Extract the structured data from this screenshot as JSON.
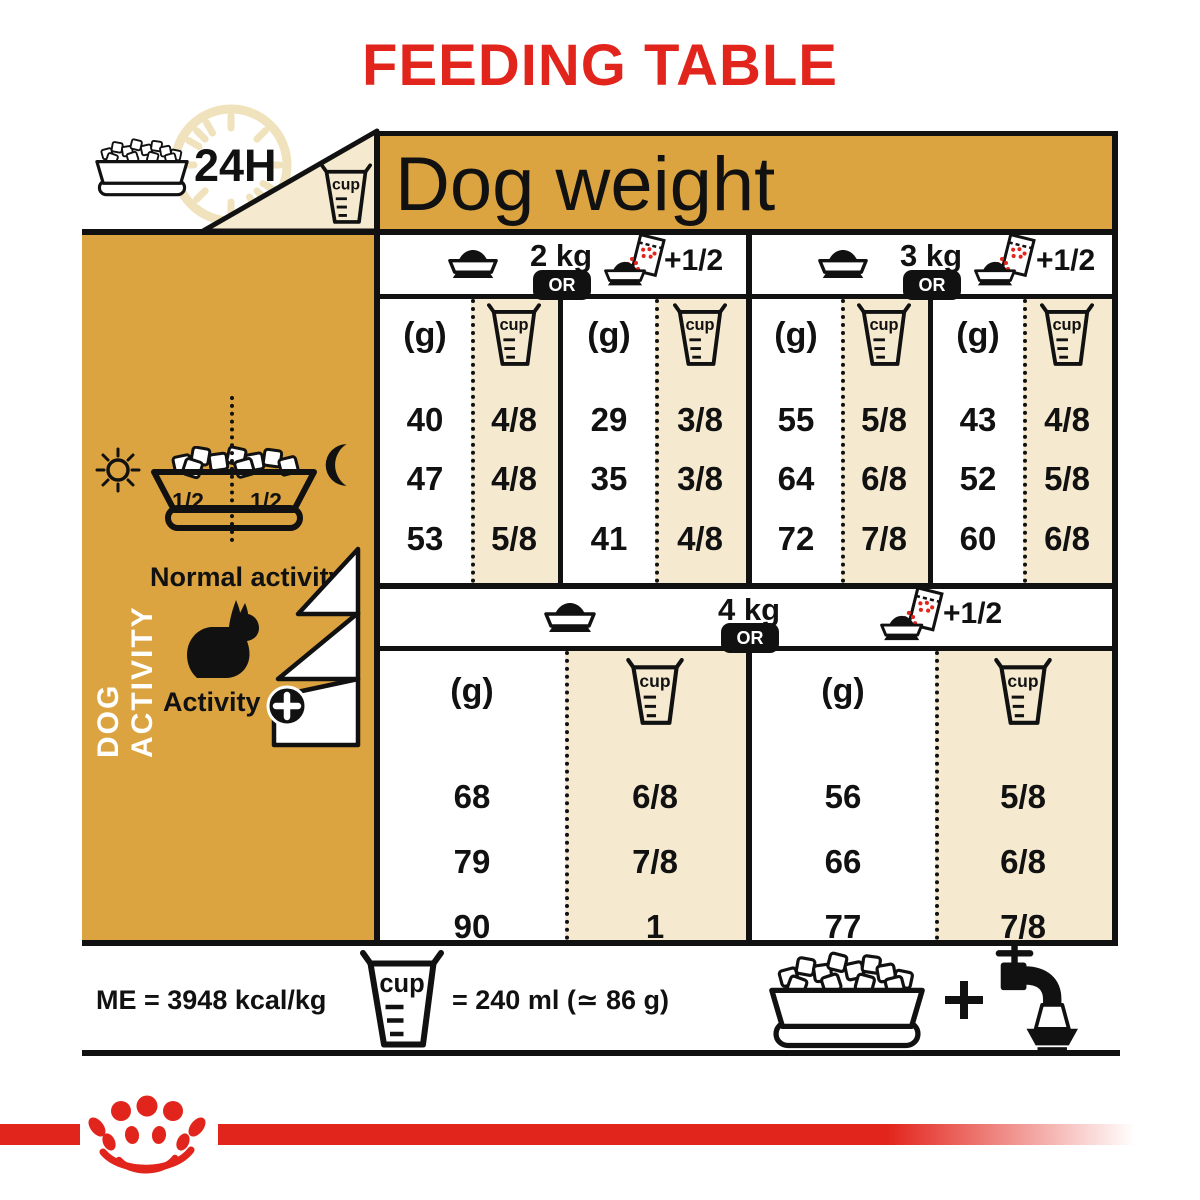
{
  "colors": {
    "red": "#E2251C",
    "gold": "#DBA440",
    "cream": "#F5E9CF",
    "black": "#111111",
    "clock_tan": "#EFE2BC"
  },
  "labels": {
    "title": "FEEDING TABLE",
    "h24": "24H",
    "cup": "cup",
    "dog_weight": "Dog weight",
    "or": "OR",
    "plus_half": "+1/2",
    "grams": "(g)",
    "half": "1/2",
    "dog_activity": "DOG ACTIVITY",
    "normal_activity": "Normal activity",
    "activity": "Activity"
  },
  "sections": [
    {
      "weight": "2 kg",
      "dry": {
        "g": [
          "40",
          "47",
          "53"
        ],
        "cups": [
          "4/8",
          "4/8",
          "5/8"
        ]
      },
      "mixed": {
        "g": [
          "29",
          "35",
          "41"
        ],
        "cups": [
          "3/8",
          "3/8",
          "4/8"
        ]
      }
    },
    {
      "weight": "3 kg",
      "dry": {
        "g": [
          "55",
          "64",
          "72"
        ],
        "cups": [
          "5/8",
          "6/8",
          "7/8"
        ]
      },
      "mixed": {
        "g": [
          "43",
          "52",
          "60"
        ],
        "cups": [
          "4/8",
          "5/8",
          "6/8"
        ]
      }
    },
    {
      "weight": "4 kg",
      "dry": {
        "g": [
          "68",
          "79",
          "90"
        ],
        "cups": [
          "6/8",
          "7/8",
          "1"
        ]
      },
      "mixed": {
        "g": [
          "56",
          "66",
          "77"
        ],
        "cups": [
          "5/8",
          "6/8",
          "7/8"
        ]
      }
    }
  ],
  "footer": {
    "me": "ME = 3948 kcal/kg",
    "cup_equiv": "= 240 ml (≃ 86 g)"
  }
}
